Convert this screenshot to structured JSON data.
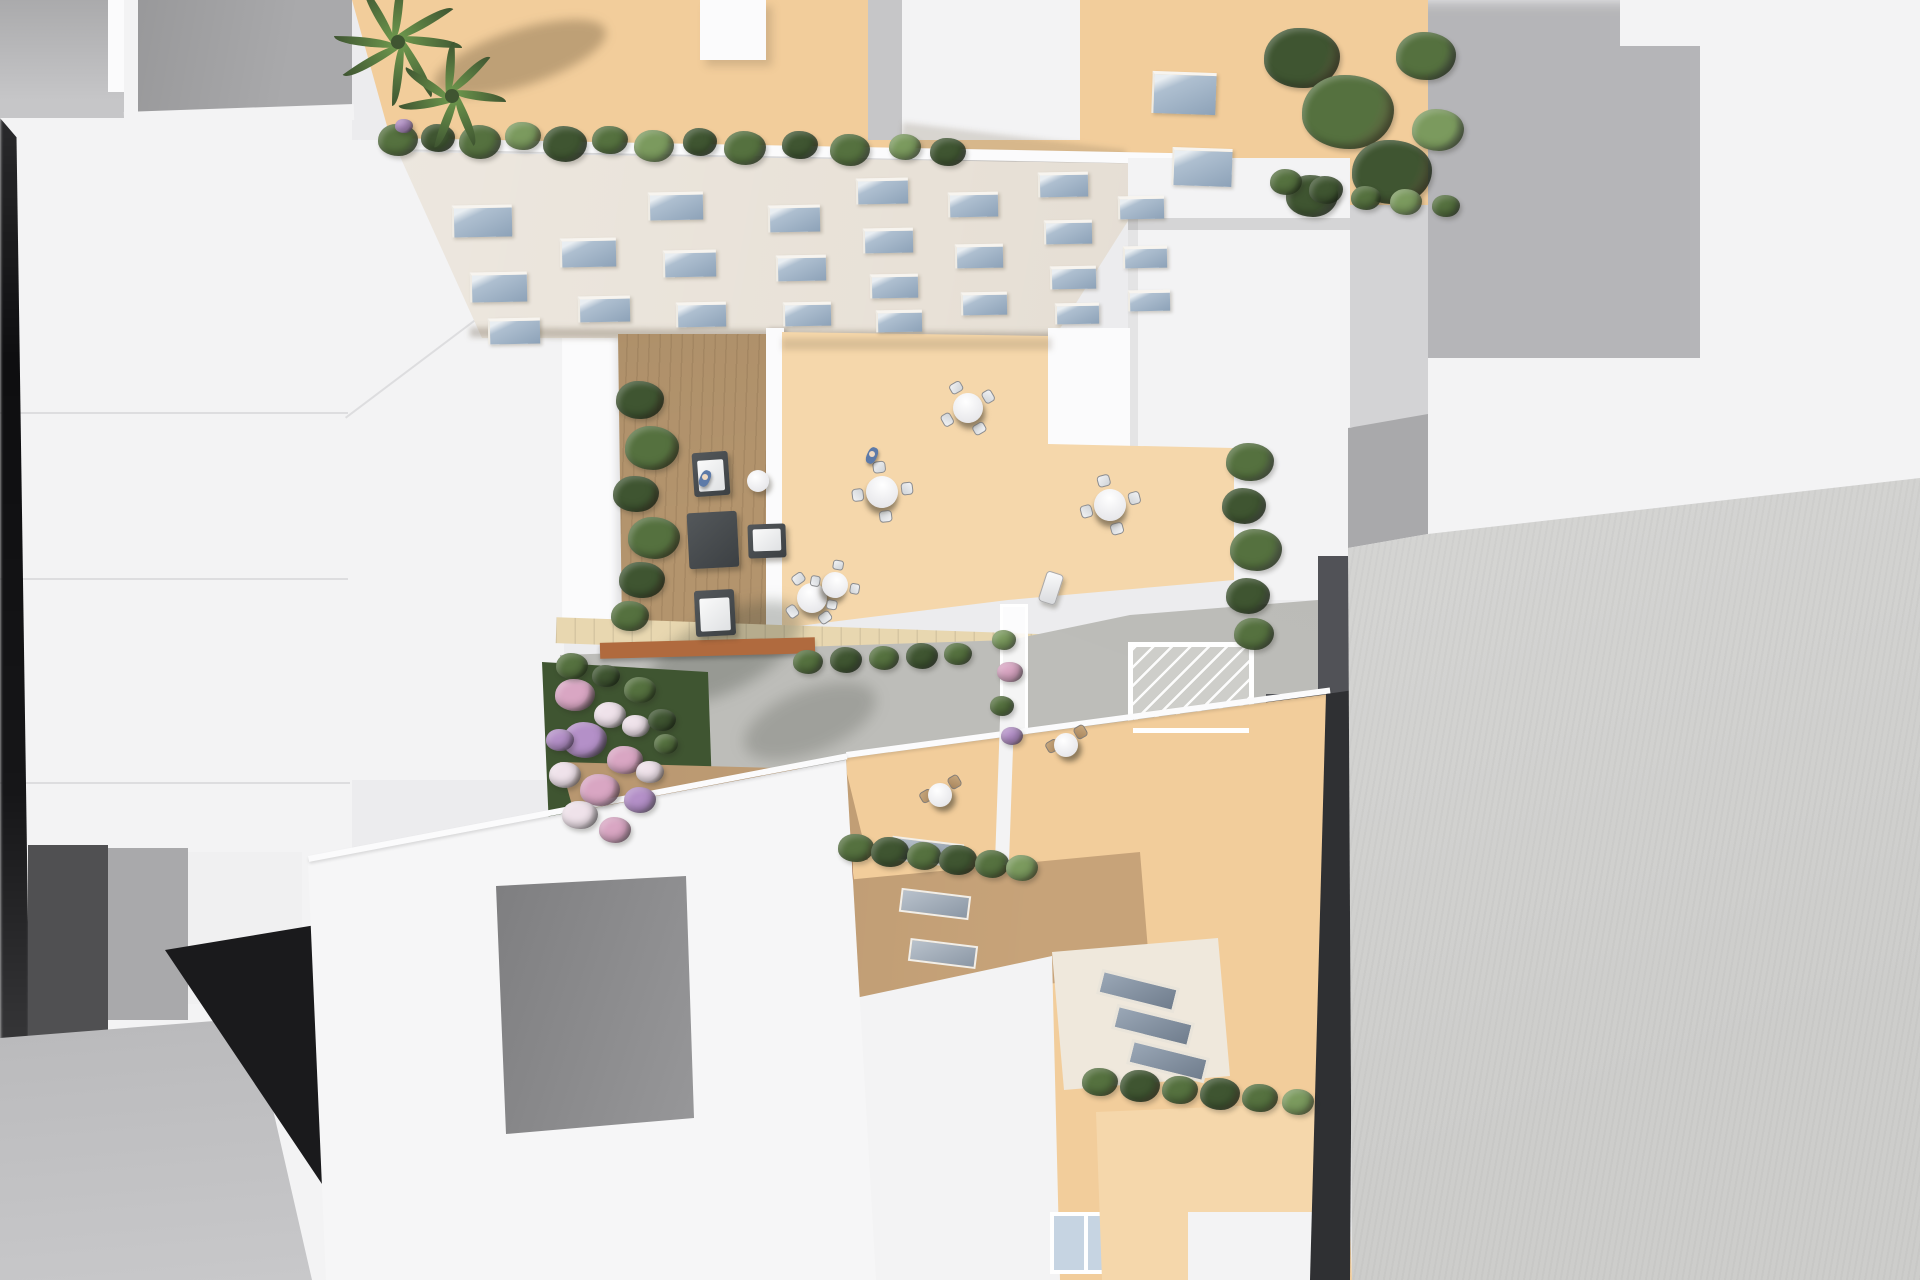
{
  "meta": {
    "type": "architectural-aerial-render",
    "description": "Top-down 3D architectural visualization of a city block: white massing-model buildings surround a detailed cream residential building with beige rooftop terraces, a wooden lounge deck, round dining tables with chairs, planters with shrubs and pink flowers, palm trees, a white glass pergola/greenhouse, and surrounding flat roofs in white and gray."
  },
  "palette": {
    "bg": "#ececee",
    "white_roof": "#f3f3f4",
    "white_bright": "#fbfbfc",
    "gray_light": "#c6c6c8",
    "gray_mid": "#a9a9ab",
    "gray_dark": "#8e8e90",
    "gray_deep": "#555557",
    "near_black": "#1a1a1c",
    "beige": "#f2cd9b",
    "beige_light": "#f5d7ab",
    "tan_wall": "#c7a379",
    "cream": "#efe8dc",
    "facade": "#e8e1d7",
    "wood": "#b3946d",
    "tile": "#e8d7b0",
    "concrete": "#bdbdb9",
    "corten": "#b06a3e",
    "corten_dark": "#8a4f2b",
    "hedge": "#55713f",
    "hedge_dark": "#3f5531",
    "hedge_light": "#7b9a5e",
    "palm": "#6f9a4e",
    "flower_pink": "#d9a6c3",
    "flower_lilac": "#b490c8",
    "flower_white": "#efe2ea",
    "glass": "#9fb3c8",
    "glass_light": "#c6d4e2",
    "charcoal": "#515257",
    "charcoal_dark": "#2f3033",
    "big_roof": "#d8d8d6",
    "table_white": "#f7f7f9",
    "chair_tan": "#c8a87e",
    "sofa_dark": "#45494c",
    "person_blue": "#5d7aa8"
  },
  "scene": {
    "facade_windows": [
      [
        452,
        205,
        60,
        32
      ],
      [
        470,
        272,
        57,
        30
      ],
      [
        488,
        318,
        52,
        26
      ],
      [
        560,
        238,
        56,
        29
      ],
      [
        578,
        296,
        52,
        26
      ],
      [
        648,
        192,
        55,
        28
      ],
      [
        663,
        250,
        53,
        27
      ],
      [
        676,
        302,
        50,
        25
      ],
      [
        768,
        205,
        52,
        27
      ],
      [
        776,
        255,
        50,
        26
      ],
      [
        783,
        302,
        48,
        24
      ],
      [
        856,
        178,
        52,
        26
      ],
      [
        863,
        228,
        50,
        25
      ],
      [
        870,
        274,
        48,
        24
      ],
      [
        876,
        310,
        46,
        22
      ],
      [
        948,
        192,
        50,
        25
      ],
      [
        955,
        244,
        48,
        24
      ],
      [
        961,
        292,
        46,
        23
      ],
      [
        1038,
        172,
        50,
        25
      ],
      [
        1044,
        220,
        48,
        24
      ],
      [
        1050,
        266,
        46,
        23
      ],
      [
        1055,
        303,
        44,
        21
      ],
      [
        1118,
        196,
        46,
        23
      ],
      [
        1123,
        246,
        44,
        22
      ],
      [
        1128,
        290,
        42,
        21
      ]
    ],
    "strip_windows": [
      [
        1152,
        72,
        64,
        42
      ],
      [
        1172,
        148,
        60,
        38
      ]
    ],
    "wall_slits": [
      [
        891,
        840,
        72,
        24,
        7
      ],
      [
        900,
        892,
        70,
        24,
        7
      ],
      [
        909,
        942,
        68,
        23,
        7
      ]
    ],
    "roof_skylights": [
      [
        1098,
        978,
        80,
        26,
        14
      ],
      [
        1113,
        1013,
        80,
        26,
        14
      ],
      [
        1128,
        1048,
        80,
        26,
        14
      ]
    ],
    "shrub_groups": {
      "parapet_row": [
        [
          398,
          140,
          20,
          "h"
        ],
        [
          404,
          126,
          9,
          "fl"
        ],
        [
          438,
          138,
          17,
          "hd"
        ],
        [
          480,
          142,
          21,
          "h"
        ],
        [
          523,
          136,
          18,
          "hl"
        ],
        [
          565,
          144,
          22,
          "hd"
        ],
        [
          610,
          140,
          18,
          "h"
        ],
        [
          654,
          146,
          20,
          "hl"
        ],
        [
          700,
          142,
          17,
          "hd"
        ],
        [
          745,
          148,
          21,
          "h"
        ],
        [
          800,
          145,
          18,
          "hd"
        ],
        [
          850,
          150,
          20,
          "h"
        ],
        [
          905,
          147,
          16,
          "hl"
        ],
        [
          948,
          152,
          18,
          "hd"
        ]
      ],
      "left_column": [
        [
          640,
          400,
          24,
          "hd"
        ],
        [
          652,
          448,
          27,
          "h"
        ],
        [
          636,
          494,
          23,
          "hd"
        ],
        [
          654,
          538,
          26,
          "h"
        ],
        [
          642,
          580,
          23,
          "hd"
        ],
        [
          630,
          616,
          19,
          "h"
        ]
      ],
      "right_trees": [
        [
          1302,
          58,
          38,
          "hd"
        ],
        [
          1348,
          112,
          46,
          "h"
        ],
        [
          1392,
          172,
          40,
          "hd"
        ],
        [
          1426,
          56,
          30,
          "h"
        ],
        [
          1312,
          196,
          26,
          "hd"
        ],
        [
          1438,
          130,
          26,
          "hl"
        ]
      ],
      "strip_bushes": [
        [
          1286,
          182,
          16,
          "h"
        ],
        [
          1326,
          190,
          17,
          "hd"
        ],
        [
          1366,
          198,
          15,
          "h"
        ],
        [
          1406,
          202,
          16,
          "hl"
        ],
        [
          1446,
          206,
          14,
          "h"
        ]
      ],
      "terrace_hedge_col": [
        [
          1250,
          462,
          24,
          "h"
        ],
        [
          1244,
          506,
          22,
          "hd"
        ],
        [
          1256,
          550,
          26,
          "h"
        ],
        [
          1248,
          596,
          22,
          "hd"
        ],
        [
          1254,
          634,
          20,
          "h"
        ]
      ],
      "patio_planter": [
        [
          808,
          662,
          15,
          "h"
        ],
        [
          846,
          660,
          16,
          "hd"
        ],
        [
          884,
          658,
          15,
          "h"
        ],
        [
          922,
          656,
          16,
          "hd"
        ],
        [
          958,
          654,
          14,
          "h"
        ]
      ],
      "hedge_mid": [
        [
          856,
          848,
          18,
          "h"
        ],
        [
          890,
          852,
          19,
          "hd"
        ],
        [
          924,
          856,
          17,
          "h"
        ],
        [
          958,
          860,
          19,
          "hd"
        ],
        [
          992,
          864,
          17,
          "h"
        ],
        [
          1022,
          868,
          16,
          "hl"
        ]
      ],
      "hedge_bottom": [
        [
          1100,
          1082,
          18,
          "h"
        ],
        [
          1140,
          1086,
          20,
          "hd"
        ],
        [
          1180,
          1090,
          18,
          "h"
        ],
        [
          1220,
          1094,
          20,
          "hd"
        ],
        [
          1260,
          1098,
          18,
          "h"
        ],
        [
          1298,
          1102,
          16,
          "hl"
        ]
      ],
      "trellis_plants": [
        [
          1004,
          640,
          12,
          "hl"
        ],
        [
          1010,
          672,
          13,
          "fp"
        ],
        [
          1002,
          706,
          12,
          "h"
        ],
        [
          1012,
          736,
          11,
          "fl"
        ]
      ]
    },
    "flowers": [
      [
        575,
        695,
        20,
        "fp"
      ],
      [
        610,
        715,
        16,
        "fw"
      ],
      [
        585,
        740,
        22,
        "fl"
      ],
      [
        625,
        760,
        18,
        "fp"
      ],
      [
        565,
        775,
        16,
        "fw"
      ],
      [
        600,
        790,
        20,
        "fp"
      ],
      [
        640,
        800,
        16,
        "fl"
      ],
      [
        580,
        815,
        18,
        "fw"
      ],
      [
        615,
        830,
        16,
        "fp"
      ],
      [
        650,
        772,
        14,
        "fw"
      ],
      [
        560,
        740,
        14,
        "fl"
      ],
      [
        636,
        726,
        14,
        "fw"
      ],
      [
        572,
        666,
        16,
        "h"
      ],
      [
        606,
        676,
        14,
        "hd"
      ],
      [
        640,
        690,
        16,
        "h"
      ],
      [
        662,
        720,
        14,
        "hd"
      ],
      [
        666,
        744,
        12,
        "h"
      ]
    ],
    "greenhouse_flowers": [
      [
        1152,
        756,
        15,
        "fp"
      ],
      [
        1182,
        768,
        13,
        "hl"
      ],
      [
        1206,
        758,
        14,
        "fl"
      ],
      [
        1166,
        786,
        12,
        "h"
      ],
      [
        1226,
        778,
        11,
        "fp"
      ]
    ],
    "palms": [
      {
        "cx": 398,
        "cy": 42,
        "n": 8,
        "len": 64
      },
      {
        "cx": 452,
        "cy": 96,
        "n": 7,
        "len": 54
      }
    ],
    "round_tables": [
      [
        812,
        598,
        15,
        10
      ],
      [
        882,
        492,
        16,
        38
      ],
      [
        968,
        408,
        15,
        15
      ],
      [
        1110,
        505,
        16,
        30
      ],
      [
        835,
        585,
        13,
        55
      ]
    ],
    "bistro_sets": [
      [
        940,
        795,
        12
      ],
      [
        1066,
        745,
        12
      ]
    ],
    "lounge": [
      {
        "t": "armchair",
        "x": 693,
        "y": 452,
        "w": 36,
        "h": 44,
        "r": -4
      },
      {
        "t": "sidetable",
        "x": 747,
        "y": 470,
        "w": 22,
        "h": 22,
        "r": 0
      },
      {
        "t": "ottoman",
        "x": 688,
        "y": 512,
        "w": 50,
        "h": 56,
        "r": -3
      },
      {
        "t": "cube",
        "x": 748,
        "y": 524,
        "w": 38,
        "h": 34,
        "r": -2
      },
      {
        "t": "sofa",
        "x": 695,
        "y": 590,
        "w": 40,
        "h": 46,
        "r": -3
      }
    ],
    "persons": [
      [
        705,
        478
      ],
      [
        872,
        455
      ]
    ],
    "loungers": [
      [
        1042,
        572
      ]
    ]
  }
}
